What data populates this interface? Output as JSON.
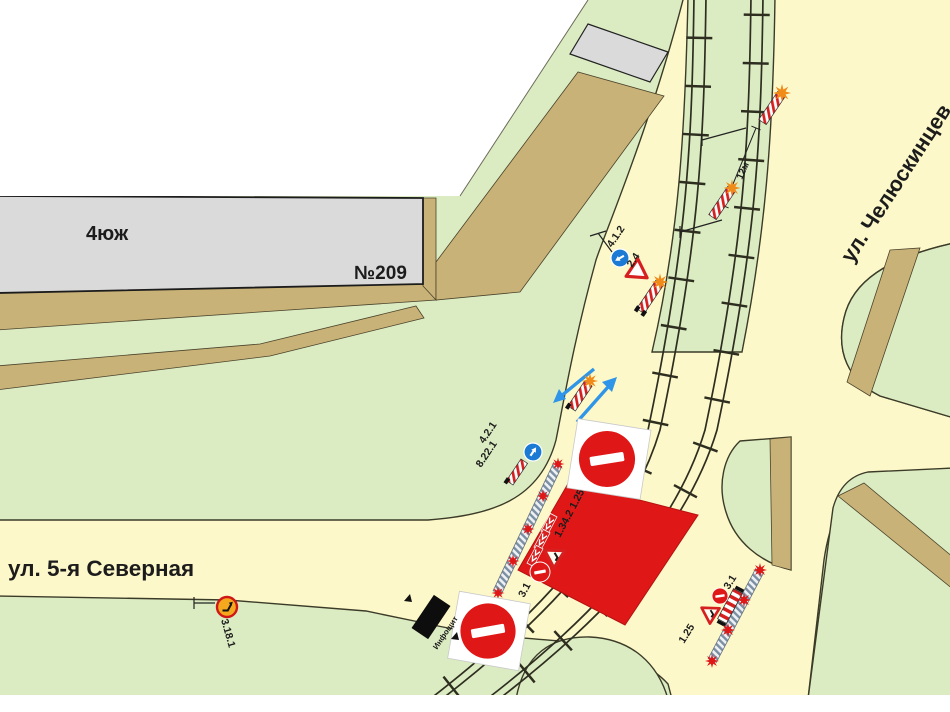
{
  "map": {
    "streets": {
      "severnaya": "ул. 5-я Северная",
      "chelyuskintsev": "ул. Челюскинцев"
    },
    "buildings": {
      "block_label": "4юж",
      "house_number": "№209"
    },
    "annotations": {
      "distance": "12м",
      "info_board": "Инфощит"
    },
    "sign_codes": {
      "give_way": "2.4",
      "direction_right": "4.1.2",
      "detour_right": "4.2.1",
      "obstacle_plate": "8.22.1",
      "chevron_roadworks_cluster": "1.34.2 1.25",
      "no_entry_cluster": "3.1",
      "no_entry_east": "3.1",
      "roadworks_east": "1.25",
      "no_turn": "3.18.1"
    },
    "colors": {
      "ground_green": "#dcecc2",
      "road_yellow": "#fcf8c9",
      "sidewalk_tan": "#c9b277",
      "building_gray": "#dadada",
      "closure_red": "#e01717",
      "sign_red": "#d62020",
      "sign_blue": "#1a7ad4",
      "lamp_orange": "#f08b1a",
      "outline_dark": "#3b3b28"
    },
    "icons": {
      "no_entry_sign": "red disc with white horizontal bar",
      "give_way_sign": "inverted white triangle with red border",
      "roadworks_sign": "white triangle with red border",
      "chevron_board": "red board with white chevrons",
      "barrier_post": "red-white striped post",
      "fence_line": "hatched barrier fence",
      "lamp": "eight-point starburst lamp",
      "info_board": "black rectangular board"
    }
  }
}
